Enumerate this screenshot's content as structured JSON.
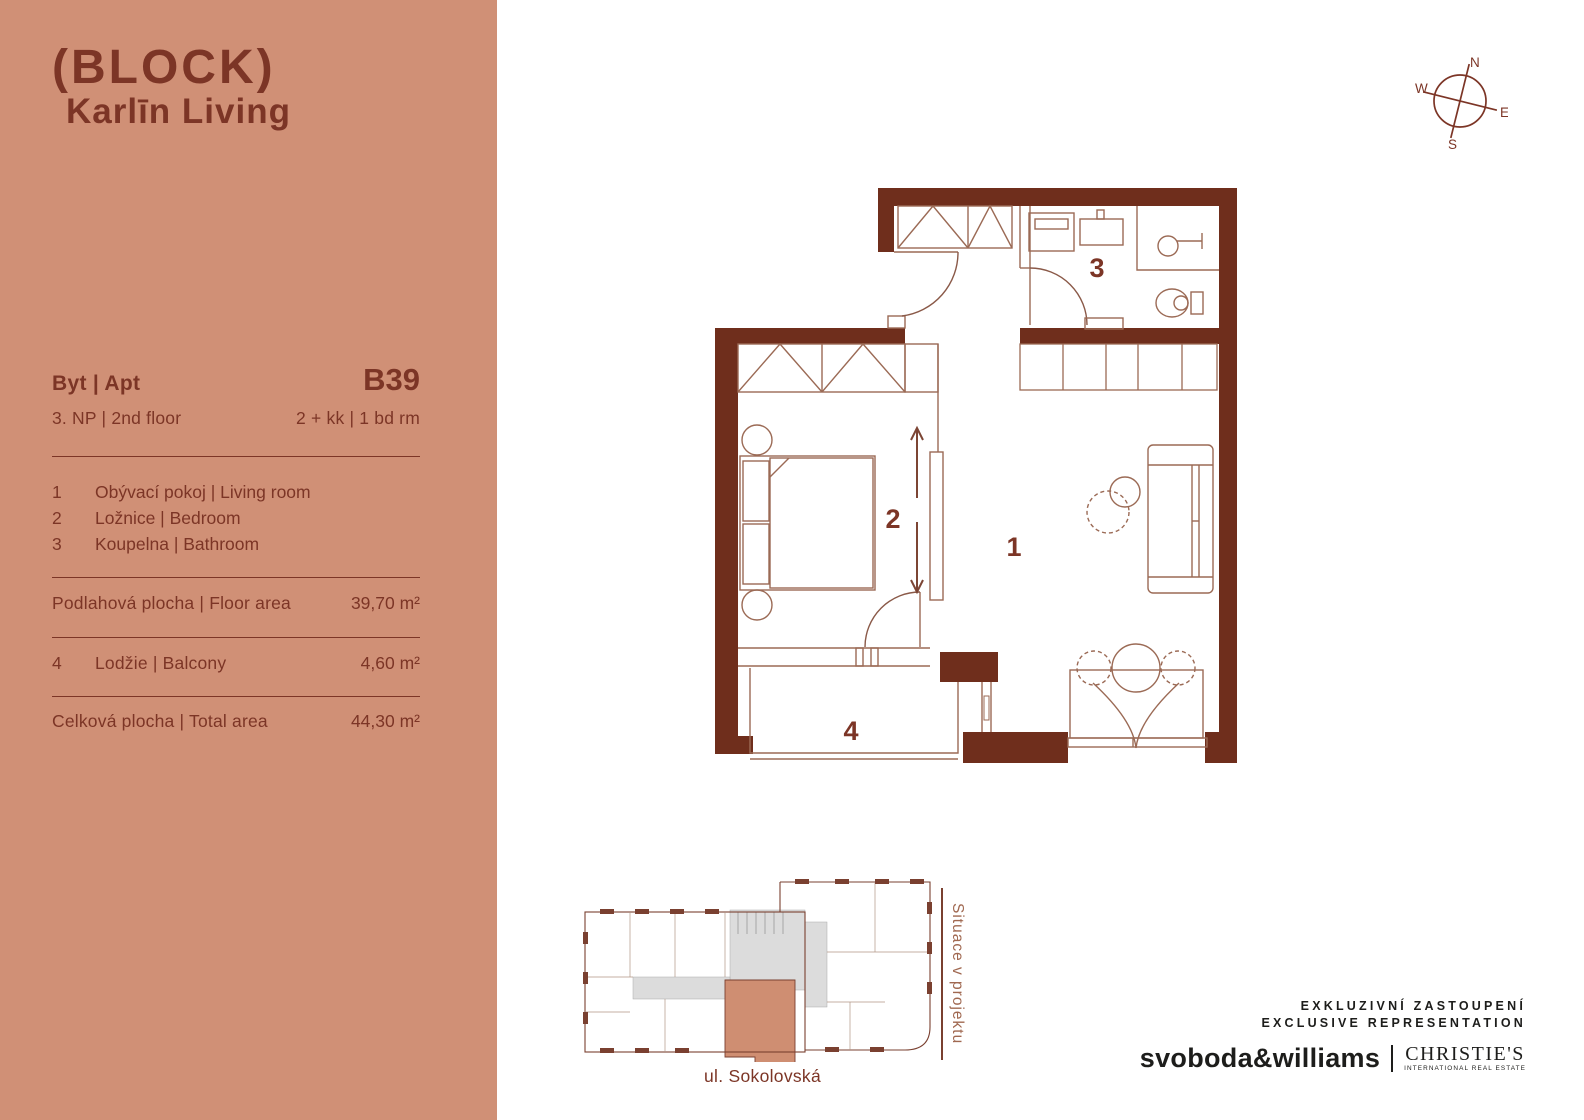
{
  "logo": {
    "line1": "(BLOCK)",
    "line2": "Karlīn Living"
  },
  "sidebar": {
    "apt_label": "Byt | Apt",
    "apt_code": "B39",
    "floor": "3. NP  |  2nd floor",
    "layout": "2 + kk  |  1 bd rm",
    "rooms": [
      {
        "num": "1",
        "label": "Obývací pokoj | Living room"
      },
      {
        "num": "2",
        "label": "Ložnice | Bedroom"
      },
      {
        "num": "3",
        "label": "Koupelna | Bathroom"
      }
    ],
    "floor_area_label": "Podlahová plocha | Floor area",
    "floor_area_value": "39,70 m²",
    "balcony_num": "4",
    "balcony_label": "Lodžie | Balcony",
    "balcony_value": "4,60 m²",
    "total_label": "Celková plocha | Total area",
    "total_value": "44,30 m²"
  },
  "compass": {
    "n": "N",
    "s": "S",
    "e": "E",
    "w": "W"
  },
  "floorplan": {
    "room1": "1",
    "room2": "2",
    "room3": "3",
    "room4": "4"
  },
  "siteplan": {
    "street": "ul. Sokolovská",
    "caption": "Situace v projektu"
  },
  "branding": {
    "line1": "EXKLUZIVNÍ ZASTOUPENÍ",
    "line2": "EXCLUSIVE REPRESENTATION",
    "agency": "svoboda&williams",
    "partner": "CHRISTIE'S",
    "partner_sub": "INTERNATIONAL REAL ESTATE"
  },
  "colors": {
    "sidebar_bg": "#d09076",
    "brown_text": "#7c3526",
    "wall": "#6f2e1c",
    "furniture_line": "#9b6a55",
    "site_grey": "#dcdcdc",
    "site_unit": "#cf8e72",
    "black": "#1d1d1b"
  }
}
